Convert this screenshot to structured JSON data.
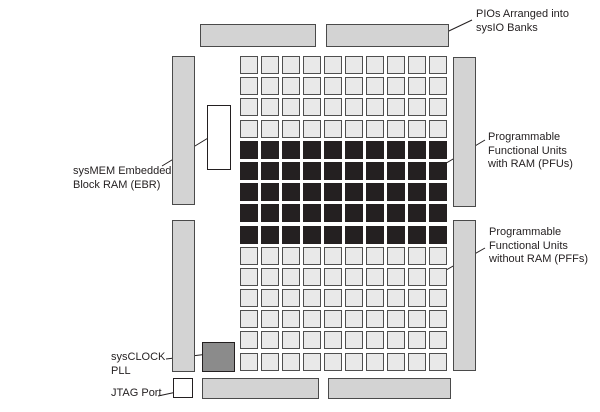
{
  "diagram": {
    "description": "FPGA device floorplan diagram",
    "labels": {
      "pio": {
        "lines": [
          "PIOs Arranged into",
          "sysIO Banks"
        ]
      },
      "pfu": {
        "lines": [
          "Programmable",
          "Functional Units",
          "with RAM (PFUs)"
        ]
      },
      "pff": {
        "lines": [
          "Programmable",
          "Functional Units",
          "without RAM (PFFs)"
        ]
      },
      "ebr": {
        "lines": [
          "sysMEM Embedded",
          "Block RAM (EBR)"
        ]
      },
      "pll": {
        "lines": [
          "sysCLOCK",
          "PLL"
        ]
      },
      "jtag": {
        "lines": [
          "JTAG Port"
        ]
      }
    },
    "grid": {
      "columns": 10,
      "rows": 15,
      "row_types": [
        "pff",
        "pff",
        "pff",
        "pff",
        "pfu",
        "pfu",
        "pfu",
        "pfu",
        "pfu",
        "pff",
        "pff",
        "pff",
        "pff",
        "pff",
        "pff"
      ]
    },
    "colors": {
      "bank_fill": "#d3d3d3",
      "bank_border": "#4a4a4a",
      "pff_fill": "#e9e9e9",
      "pfu_fill": "#242021",
      "cell_border": "#4f4f4f",
      "pll_fill": "#8b8b8b",
      "white_fill": "#ffffff",
      "line": "#231f20",
      "text": "#231f20",
      "background": "#ffffff"
    }
  }
}
